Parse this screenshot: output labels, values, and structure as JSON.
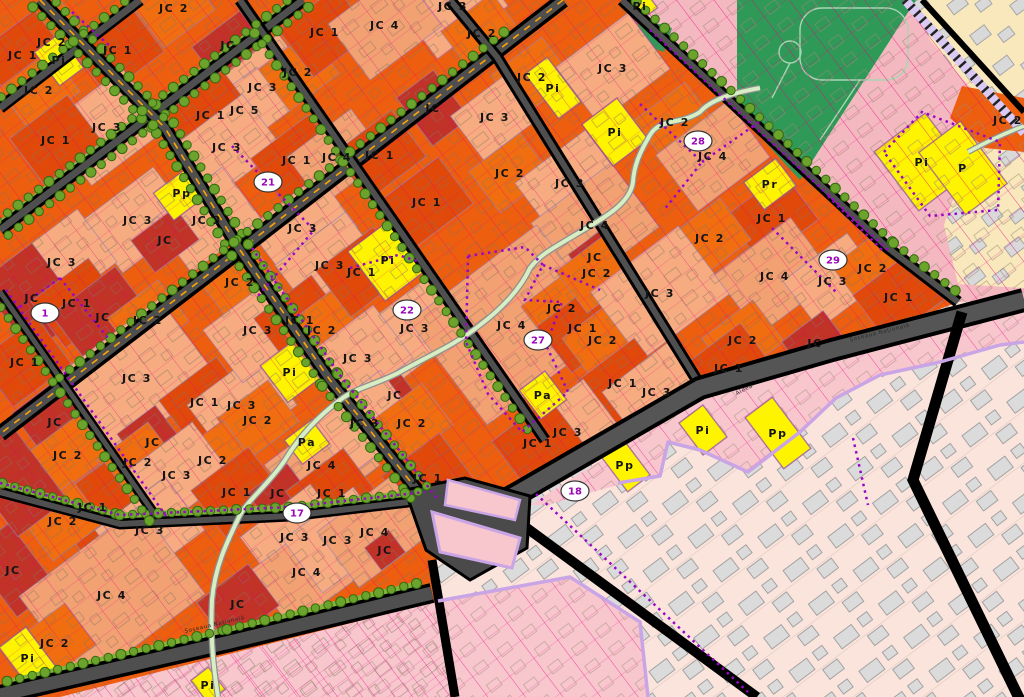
{
  "map": {
    "title": "Urban zoning plan map",
    "palette": {
      "base_orange": "#ED5E0F",
      "patch": {
        "JC": "#C13227",
        "JC1": "#E0490A",
        "JC2": "#F06E10",
        "JC3": "#F6AC80",
        "JC4": "#F2A173",
        "JC5": "#F6AC80",
        "P": "#FFF400"
      },
      "pink_zone": "#F4B9C0",
      "pink_strip": "#F8C7CE",
      "cream_zone": "#F8E8BC",
      "faded_zone": "#FBE4DB",
      "park_green": "#2F9958",
      "tree_green": "#6CA32C",
      "tree_edge": "#336B10",
      "grass_strip": "#83B238",
      "road_dark": "#4F4F4F",
      "road_black": "#000000",
      "road_dash": "#FFA400",
      "magenta_line": "#E8007E",
      "purple_dots": "#9906C8",
      "lavender": "#C9A5E6",
      "lilac_road": "#D9C9F4",
      "stream_fill": "#D7EDC2",
      "stream_edge": "#8F8F8F",
      "badge_fill": "#FFFFFF",
      "badge_edge": "#333333",
      "badge_text": "#9A06B8",
      "label_text": "#141414",
      "building_gray": "#DBDBDB",
      "building_edge": "#9C9C9C"
    },
    "badges": [
      {
        "n": "1",
        "x": 45,
        "y": 313
      },
      {
        "n": "17",
        "x": 297,
        "y": 513
      },
      {
        "n": "18",
        "x": 575,
        "y": 491
      },
      {
        "n": "21",
        "x": 268,
        "y": 182
      },
      {
        "n": "22",
        "x": 407,
        "y": 310
      },
      {
        "n": "27",
        "x": 538,
        "y": 340
      },
      {
        "n": "28",
        "x": 698,
        "y": 141
      },
      {
        "n": "29",
        "x": 833,
        "y": 260
      }
    ],
    "street_names": [
      {
        "t": "Şoseaua Naţională",
        "x": 215,
        "y": 626,
        "r": -13
      },
      {
        "t": "Şoseaua Naţională",
        "x": 880,
        "y": 334,
        "r": -14
      },
      {
        "t": "Aleea",
        "x": 745,
        "y": 391,
        "r": -27
      }
    ],
    "labels": [
      {
        "t": "JC 2",
        "x": 52,
        "y": 42
      },
      {
        "t": "JC 1",
        "x": 23,
        "y": 55
      },
      {
        "t": "JC 1",
        "x": 118,
        "y": 50
      },
      {
        "t": "JC 2",
        "x": 174,
        "y": 8
      },
      {
        "t": "JC 2",
        "x": 39,
        "y": 90
      },
      {
        "t": "JC 3",
        "x": 107,
        "y": 127,
        "w": 95,
        "h": 75
      },
      {
        "t": "JC 1",
        "x": 56,
        "y": 140
      },
      {
        "t": "JC",
        "x": 228,
        "y": 45,
        "w": 60,
        "h": 40
      },
      {
        "t": "JC 3",
        "x": 263,
        "y": 87
      },
      {
        "t": "JC 2",
        "x": 298,
        "y": 72
      },
      {
        "t": "JC 1",
        "x": 325,
        "y": 32
      },
      {
        "t": "JC 5",
        "x": 245,
        "y": 110
      },
      {
        "t": "JC 1",
        "x": 211,
        "y": 115
      },
      {
        "t": "JC 3",
        "x": 227,
        "y": 147
      },
      {
        "t": "JC 1",
        "x": 297,
        "y": 160
      },
      {
        "t": "JC 4",
        "x": 337,
        "y": 157,
        "w": 80,
        "h": 60
      },
      {
        "t": "Pi",
        "x": 59,
        "y": 60,
        "w": 30,
        "h": 42
      },
      {
        "t": "Pp",
        "x": 182,
        "y": 193,
        "w": 46,
        "h": 34
      },
      {
        "t": "JC 3",
        "x": 138,
        "y": 220
      },
      {
        "t": "JC 3",
        "x": 207,
        "y": 220
      },
      {
        "t": "JC",
        "x": 165,
        "y": 240,
        "w": 55,
        "h": 40
      },
      {
        "t": "JC 3",
        "x": 303,
        "y": 228
      },
      {
        "t": "JC",
        "x": 433,
        "y": 108,
        "w": 46,
        "h": 60
      },
      {
        "t": "JC 3",
        "x": 453,
        "y": 6
      },
      {
        "t": "JC 4",
        "x": 385,
        "y": 25,
        "w": 90,
        "h": 70
      },
      {
        "t": "JC 2",
        "x": 482,
        "y": 33
      },
      {
        "t": "JC 2",
        "x": 532,
        "y": 77
      },
      {
        "t": "Pi",
        "x": 553,
        "y": 88,
        "w": 28,
        "h": 56
      },
      {
        "t": "JC 3",
        "x": 613,
        "y": 68,
        "w": 90,
        "h": 70
      },
      {
        "t": "Pi",
        "x": 615,
        "y": 132,
        "w": 44,
        "h": 52
      },
      {
        "t": "JC 2",
        "x": 675,
        "y": 122
      },
      {
        "t": "JC 3",
        "x": 495,
        "y": 117,
        "w": 70,
        "h": 55
      },
      {
        "t": "JC 1",
        "x": 380,
        "y": 155
      },
      {
        "t": "JC 2",
        "x": 510,
        "y": 173
      },
      {
        "t": "JC 3",
        "x": 570,
        "y": 183
      },
      {
        "t": "JC 1",
        "x": 427,
        "y": 202
      },
      {
        "t": "JC 4",
        "x": 595,
        "y": 225,
        "w": 100,
        "h": 80
      },
      {
        "t": "Pi",
        "x": 640,
        "y": 6,
        "w": 26,
        "h": 24
      },
      {
        "t": "JC 4",
        "x": 713,
        "y": 156,
        "w": 90,
        "h": 70
      },
      {
        "t": "Pr",
        "x": 770,
        "y": 184,
        "w": 40,
        "h": 34
      },
      {
        "t": "JC 1",
        "x": 772,
        "y": 218
      },
      {
        "t": "JC 2",
        "x": 710,
        "y": 238
      },
      {
        "t": "Pi",
        "x": 922,
        "y": 162,
        "w": 64,
        "h": 74
      },
      {
        "t": "P",
        "x": 963,
        "y": 168,
        "w": 52,
        "h": 78
      },
      {
        "t": "JC 2",
        "x": 1008,
        "y": 120
      },
      {
        "t": "JC 3",
        "x": 62,
        "y": 262
      },
      {
        "t": "JC 2",
        "x": 240,
        "y": 282
      },
      {
        "t": "JC",
        "x": 32,
        "y": 298,
        "w": 66,
        "h": 88
      },
      {
        "t": "JC 1",
        "x": 77,
        "y": 303
      },
      {
        "t": "JC",
        "x": 103,
        "y": 317,
        "w": 80,
        "h": 66
      },
      {
        "t": "JC 2",
        "x": 148,
        "y": 320
      },
      {
        "t": "JC 3",
        "x": 137,
        "y": 378,
        "w": 130,
        "h": 100
      },
      {
        "t": "JC 1",
        "x": 25,
        "y": 362
      },
      {
        "t": "JC",
        "x": 55,
        "y": 422,
        "w": 58,
        "h": 66
      },
      {
        "t": "JC 2",
        "x": 68,
        "y": 455
      },
      {
        "t": "JC 1",
        "x": 205,
        "y": 402
      },
      {
        "t": "JC 3",
        "x": 242,
        "y": 405
      },
      {
        "t": "JC 2",
        "x": 258,
        "y": 420
      },
      {
        "t": "JC",
        "x": 153,
        "y": 442,
        "w": 48,
        "h": 56
      },
      {
        "t": "JC 2",
        "x": 138,
        "y": 462
      },
      {
        "t": "JC 2",
        "x": 213,
        "y": 460
      },
      {
        "t": "JC 3",
        "x": 177,
        "y": 475
      },
      {
        "t": "JC 3",
        "x": 330,
        "y": 265
      },
      {
        "t": "JC 3",
        "x": 258,
        "y": 330
      },
      {
        "t": "JC 1",
        "x": 300,
        "y": 320
      },
      {
        "t": "JC 2",
        "x": 322,
        "y": 330
      },
      {
        "t": "Pi",
        "x": 290,
        "y": 372,
        "w": 40,
        "h": 46
      },
      {
        "t": "Pa",
        "x": 307,
        "y": 442,
        "w": 34,
        "h": 30
      },
      {
        "t": "JC 4",
        "x": 322,
        "y": 465
      },
      {
        "t": "Pi",
        "x": 388,
        "y": 260,
        "w": 54,
        "h": 62
      },
      {
        "t": "JC 1",
        "x": 362,
        "y": 272
      },
      {
        "t": "JC 3",
        "x": 415,
        "y": 328
      },
      {
        "t": "JC 4",
        "x": 512,
        "y": 325,
        "w": 160,
        "h": 130
      },
      {
        "t": "JC 2",
        "x": 562,
        "y": 308
      },
      {
        "t": "JC 1",
        "x": 583,
        "y": 328
      },
      {
        "t": "JC 2",
        "x": 603,
        "y": 340
      },
      {
        "t": "JC",
        "x": 595,
        "y": 257,
        "w": 40,
        "h": 36
      },
      {
        "t": "JC 2",
        "x": 597,
        "y": 273
      },
      {
        "t": "JC 3",
        "x": 660,
        "y": 293,
        "w": 110,
        "h": 85
      },
      {
        "t": "JC 1",
        "x": 623,
        "y": 383
      },
      {
        "t": "JC 3",
        "x": 657,
        "y": 392
      },
      {
        "t": "JC 3",
        "x": 358,
        "y": 358
      },
      {
        "t": "JC",
        "x": 395,
        "y": 395,
        "w": 34,
        "h": 30
      },
      {
        "t": "JC 3",
        "x": 365,
        "y": 423
      },
      {
        "t": "JC 2",
        "x": 412,
        "y": 423
      },
      {
        "t": "Pa",
        "x": 543,
        "y": 395,
        "w": 32,
        "h": 36
      },
      {
        "t": "JC 3",
        "x": 568,
        "y": 432
      },
      {
        "t": "JC 1",
        "x": 538,
        "y": 443
      },
      {
        "t": "JC 1",
        "x": 428,
        "y": 478
      },
      {
        "t": "Pp",
        "x": 625,
        "y": 465,
        "w": 28,
        "h": 46
      },
      {
        "t": "JC 4",
        "x": 775,
        "y": 276,
        "w": 95,
        "h": 75
      },
      {
        "t": "JC 3",
        "x": 833,
        "y": 281,
        "w": 80,
        "h": 60
      },
      {
        "t": "JC 2",
        "x": 873,
        "y": 268
      },
      {
        "t": "JC 1",
        "x": 899,
        "y": 297
      },
      {
        "t": "JC 2",
        "x": 743,
        "y": 340
      },
      {
        "t": "JC 1",
        "x": 729,
        "y": 368
      },
      {
        "t": "JC",
        "x": 815,
        "y": 343,
        "w": 52,
        "h": 42
      },
      {
        "t": "Pi",
        "x": 703,
        "y": 430,
        "w": 30,
        "h": 40
      },
      {
        "t": "Pp",
        "x": 778,
        "y": 433,
        "w": 34,
        "h": 64
      },
      {
        "t": "JC 1",
        "x": 93,
        "y": 507
      },
      {
        "t": "JC 2",
        "x": 63,
        "y": 521
      },
      {
        "t": "JC 3",
        "x": 150,
        "y": 530
      },
      {
        "t": "JC",
        "x": 13,
        "y": 570,
        "w": 50,
        "h": 80
      },
      {
        "t": "",
        "x": 14,
        "y": 480,
        "w": 62,
        "h": 95,
        "k": "JC"
      },
      {
        "t": "JC 4",
        "x": 112,
        "y": 595,
        "w": 150,
        "h": 110
      },
      {
        "t": "JC 2",
        "x": 55,
        "y": 643
      },
      {
        "t": "Pi",
        "x": 28,
        "y": 658,
        "w": 34,
        "h": 52
      },
      {
        "t": "JC 1",
        "x": 237,
        "y": 492
      },
      {
        "t": "JC",
        "x": 278,
        "y": 493,
        "w": 50,
        "h": 36
      },
      {
        "t": "JC 1",
        "x": 332,
        "y": 493
      },
      {
        "t": "JC 3",
        "x": 295,
        "y": 537
      },
      {
        "t": "JC 4",
        "x": 307,
        "y": 572
      },
      {
        "t": "JC",
        "x": 238,
        "y": 604,
        "w": 64,
        "h": 52
      },
      {
        "t": "JC 3",
        "x": 338,
        "y": 540
      },
      {
        "t": "Pi",
        "x": 208,
        "y": 685,
        "w": 22,
        "h": 28
      },
      {
        "t": "JC 4",
        "x": 375,
        "y": 532
      },
      {
        "t": "JC",
        "x": 385,
        "y": 550,
        "w": 30,
        "h": 28
      }
    ]
  }
}
